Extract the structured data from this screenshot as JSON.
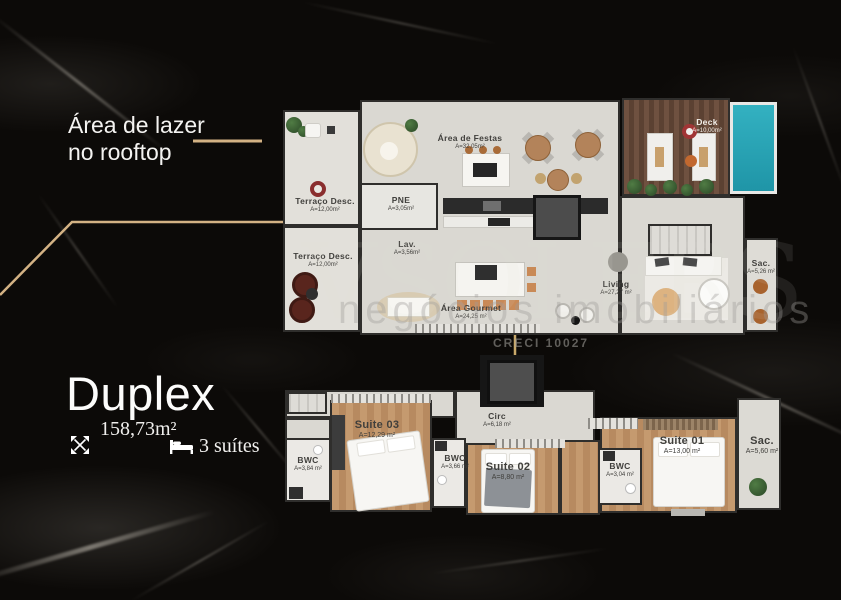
{
  "left_panel": {
    "callout_line1": "Área de lazer",
    "callout_line2": "no rooftop",
    "title": "Duplex",
    "total_area": "158,73m²",
    "suites": "3 suítes"
  },
  "watermark": {
    "brand": "VSOLERS",
    "tagline": "negócios  imobiliários",
    "creci": "CRECI 10027"
  },
  "colors": {
    "gold": "#d3b284",
    "pool_teal": "#2aa6b6",
    "background": "#0c0a08"
  },
  "upper_plan": {
    "terraco1": {
      "name": "Terraço Desc.",
      "area": "A=12,00m²"
    },
    "terraco2": {
      "name": "Terraço Desc.",
      "area": "A=12,00m²"
    },
    "pne": {
      "name": "PNE",
      "area": "A=3,05m²"
    },
    "lav": {
      "name": "Lav.",
      "area": "A=3,56m²"
    },
    "festas": {
      "name": "Área de Festas",
      "area": "A=32,05m²"
    },
    "deck": {
      "name": "Deck",
      "area": "A=10,00m²"
    },
    "gourmet": {
      "name": "Área Gourmet",
      "area": "A=24,25 m²"
    },
    "living": {
      "name": "Living",
      "area": "A=27,27 m²"
    },
    "sacada": {
      "name": "Sac.",
      "area": "A=5,26 m²"
    }
  },
  "lower_plan": {
    "circ": {
      "name": "Circ",
      "area": "A=6,18 m²"
    },
    "bwc1": {
      "name": "BWC",
      "area": "A=3,84 m²"
    },
    "suite3": {
      "name": "Suite 03",
      "area": "A=12,29 m²"
    },
    "bwc2": {
      "name": "BWC",
      "area": "A=3,66 m²"
    },
    "suite2": {
      "name": "Suite 02",
      "area": "A=8,80 m²"
    },
    "bwc3": {
      "name": "BWC",
      "area": "A=3,04 m²"
    },
    "suite1": {
      "name": "Suite 01",
      "area": "A=13,00 m²"
    },
    "sacada": {
      "name": "Sac.",
      "area": "A=5,60 m²"
    }
  }
}
